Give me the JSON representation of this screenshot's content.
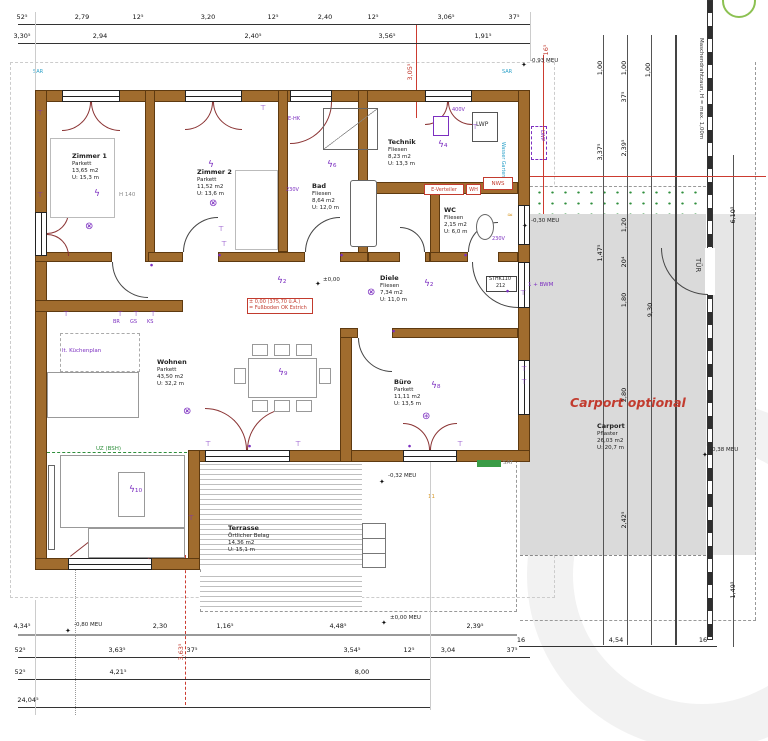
{
  "rooms": [
    {
      "name": "Zimmer 1",
      "floor": "Parkett",
      "area": "13,65 m2",
      "perim": "U: 15,3 m"
    },
    {
      "name": "Zimmer 2",
      "floor": "Parkett",
      "area": "11,52 m2",
      "perim": "U: 13,6 m"
    },
    {
      "name": "Bad",
      "floor": "Fliesen",
      "area": "8,64 m2",
      "perim": "U: 12,0 m"
    },
    {
      "name": "Technik",
      "floor": "Fliesen",
      "area": "8,23 m2",
      "perim": "U: 13,3 m"
    },
    {
      "name": "WC",
      "floor": "Fliesen",
      "area": "2,15 m2",
      "perim": "U: 6,0 m"
    },
    {
      "name": "Diele",
      "floor": "Fliesen",
      "area": "7,34 m2",
      "perim": "U: 11,0 m"
    },
    {
      "name": "Wohnen",
      "floor": "Parkett",
      "area": "43,50 m2",
      "perim": "U: 32,2 m"
    },
    {
      "name": "Büro",
      "floor": "Parkett",
      "area": "11,11 m2",
      "perim": "U: 13,5 m"
    },
    {
      "name": "Terrasse",
      "floor": "Örtlicher Belag",
      "area": "14,36 m2",
      "perim": "U: 15,1 m"
    },
    {
      "name": "Carport",
      "floor": "Pflaster",
      "area": "26,03 m2",
      "perim": "U: 20,7 m"
    }
  ],
  "annotations": {
    "carport_optional": "Carport optional",
    "level_line1": "± 0,00 (375,70 ü.A.)",
    "level_line2": "= Fußboden OK Estrich",
    "level_zero": "±0,00",
    "uz_beam": "UZ (BSH)",
    "sat": "SAT",
    "kitchen_note": "lt. Küchenplan",
    "br": "BR",
    "gs": "GS",
    "ks": "KS",
    "h140": "H 140",
    "lwp": "LWP",
    "nws": "NWS",
    "wh": "WH",
    "e_verteiler": "E-Verteiler",
    "bwm": "1 + BWM",
    "v400": "400V",
    "v230": "230V",
    "e_hk": "E-HK",
    "sthk_1": "STHK110",
    "sthk_2": "212",
    "tuer": "TÜR",
    "fence": "Maschendrahtzaun, H = max. 1,00m",
    "wasser": "Wasser Garten",
    "sar": "SAR",
    "eleven": "11",
    "wave": "≈"
  },
  "levels": [
    "-0,80 MEU",
    "±0,00 MEU",
    "-0,32 MEU",
    "-0,30 MEU",
    "-0,93 MEU",
    "-0,38 MEU"
  ],
  "dims": {
    "t1": [
      "52⁵",
      "2,79",
      "12⁵",
      "3,20",
      "12⁵",
      "2,40",
      "12⁵",
      "3,06⁵",
      "37⁵"
    ],
    "t2": [
      "3,30⁵",
      "2,94",
      "2,40⁵",
      "3,56⁵",
      "1,91⁵"
    ],
    "b1": [
      "4,34⁵",
      "2,30",
      "1,16⁵",
      "4,48⁵",
      "2,39⁵"
    ],
    "b2": [
      "52⁵",
      "3,63⁵",
      "37⁵",
      "3,54⁵",
      "12⁵",
      "3,04",
      "37⁵"
    ],
    "b3": [
      "52⁵",
      "4,21⁵",
      "8,00"
    ],
    "b4": [
      "24,04⁵"
    ],
    "cb": [
      "16",
      "4,54",
      "16"
    ],
    "r1": [
      "1,00",
      "3,37⁵",
      "1,47⁵"
    ],
    "r2": [
      "1,00",
      "37⁵",
      "2,39⁵",
      "1,20",
      "20⁴",
      "1,80",
      "2,80",
      "2,42⁵"
    ],
    "r3": [
      "1,00",
      "9,30"
    ],
    "r4": [
      "6,10⁵",
      "1,49⁵"
    ],
    "red_top": "3,05⁵",
    "red_mid": "16⁵",
    "red_bottom": "3,63⁵"
  },
  "symbols": {
    "lamp": "⊗",
    "fan": "⊛",
    "bolt": "ϟ",
    "bolt2": "ϟ₂",
    "bolt4": "ϟ₄",
    "bolt6": "ϟ₆",
    "bolt8": "ϟ₈",
    "bolt9": "ϟ₉",
    "bolt10": "ϟ₁₀",
    "socket": "⊤",
    "dot": "●",
    "star": "✦"
  },
  "colors": {
    "wall": "#a06c2e",
    "red": "#c23b2e",
    "purple": "#7c2fc0",
    "green": "#2f8f3c",
    "cyan": "#2aa0c8",
    "carport_gray": "#dadada"
  }
}
